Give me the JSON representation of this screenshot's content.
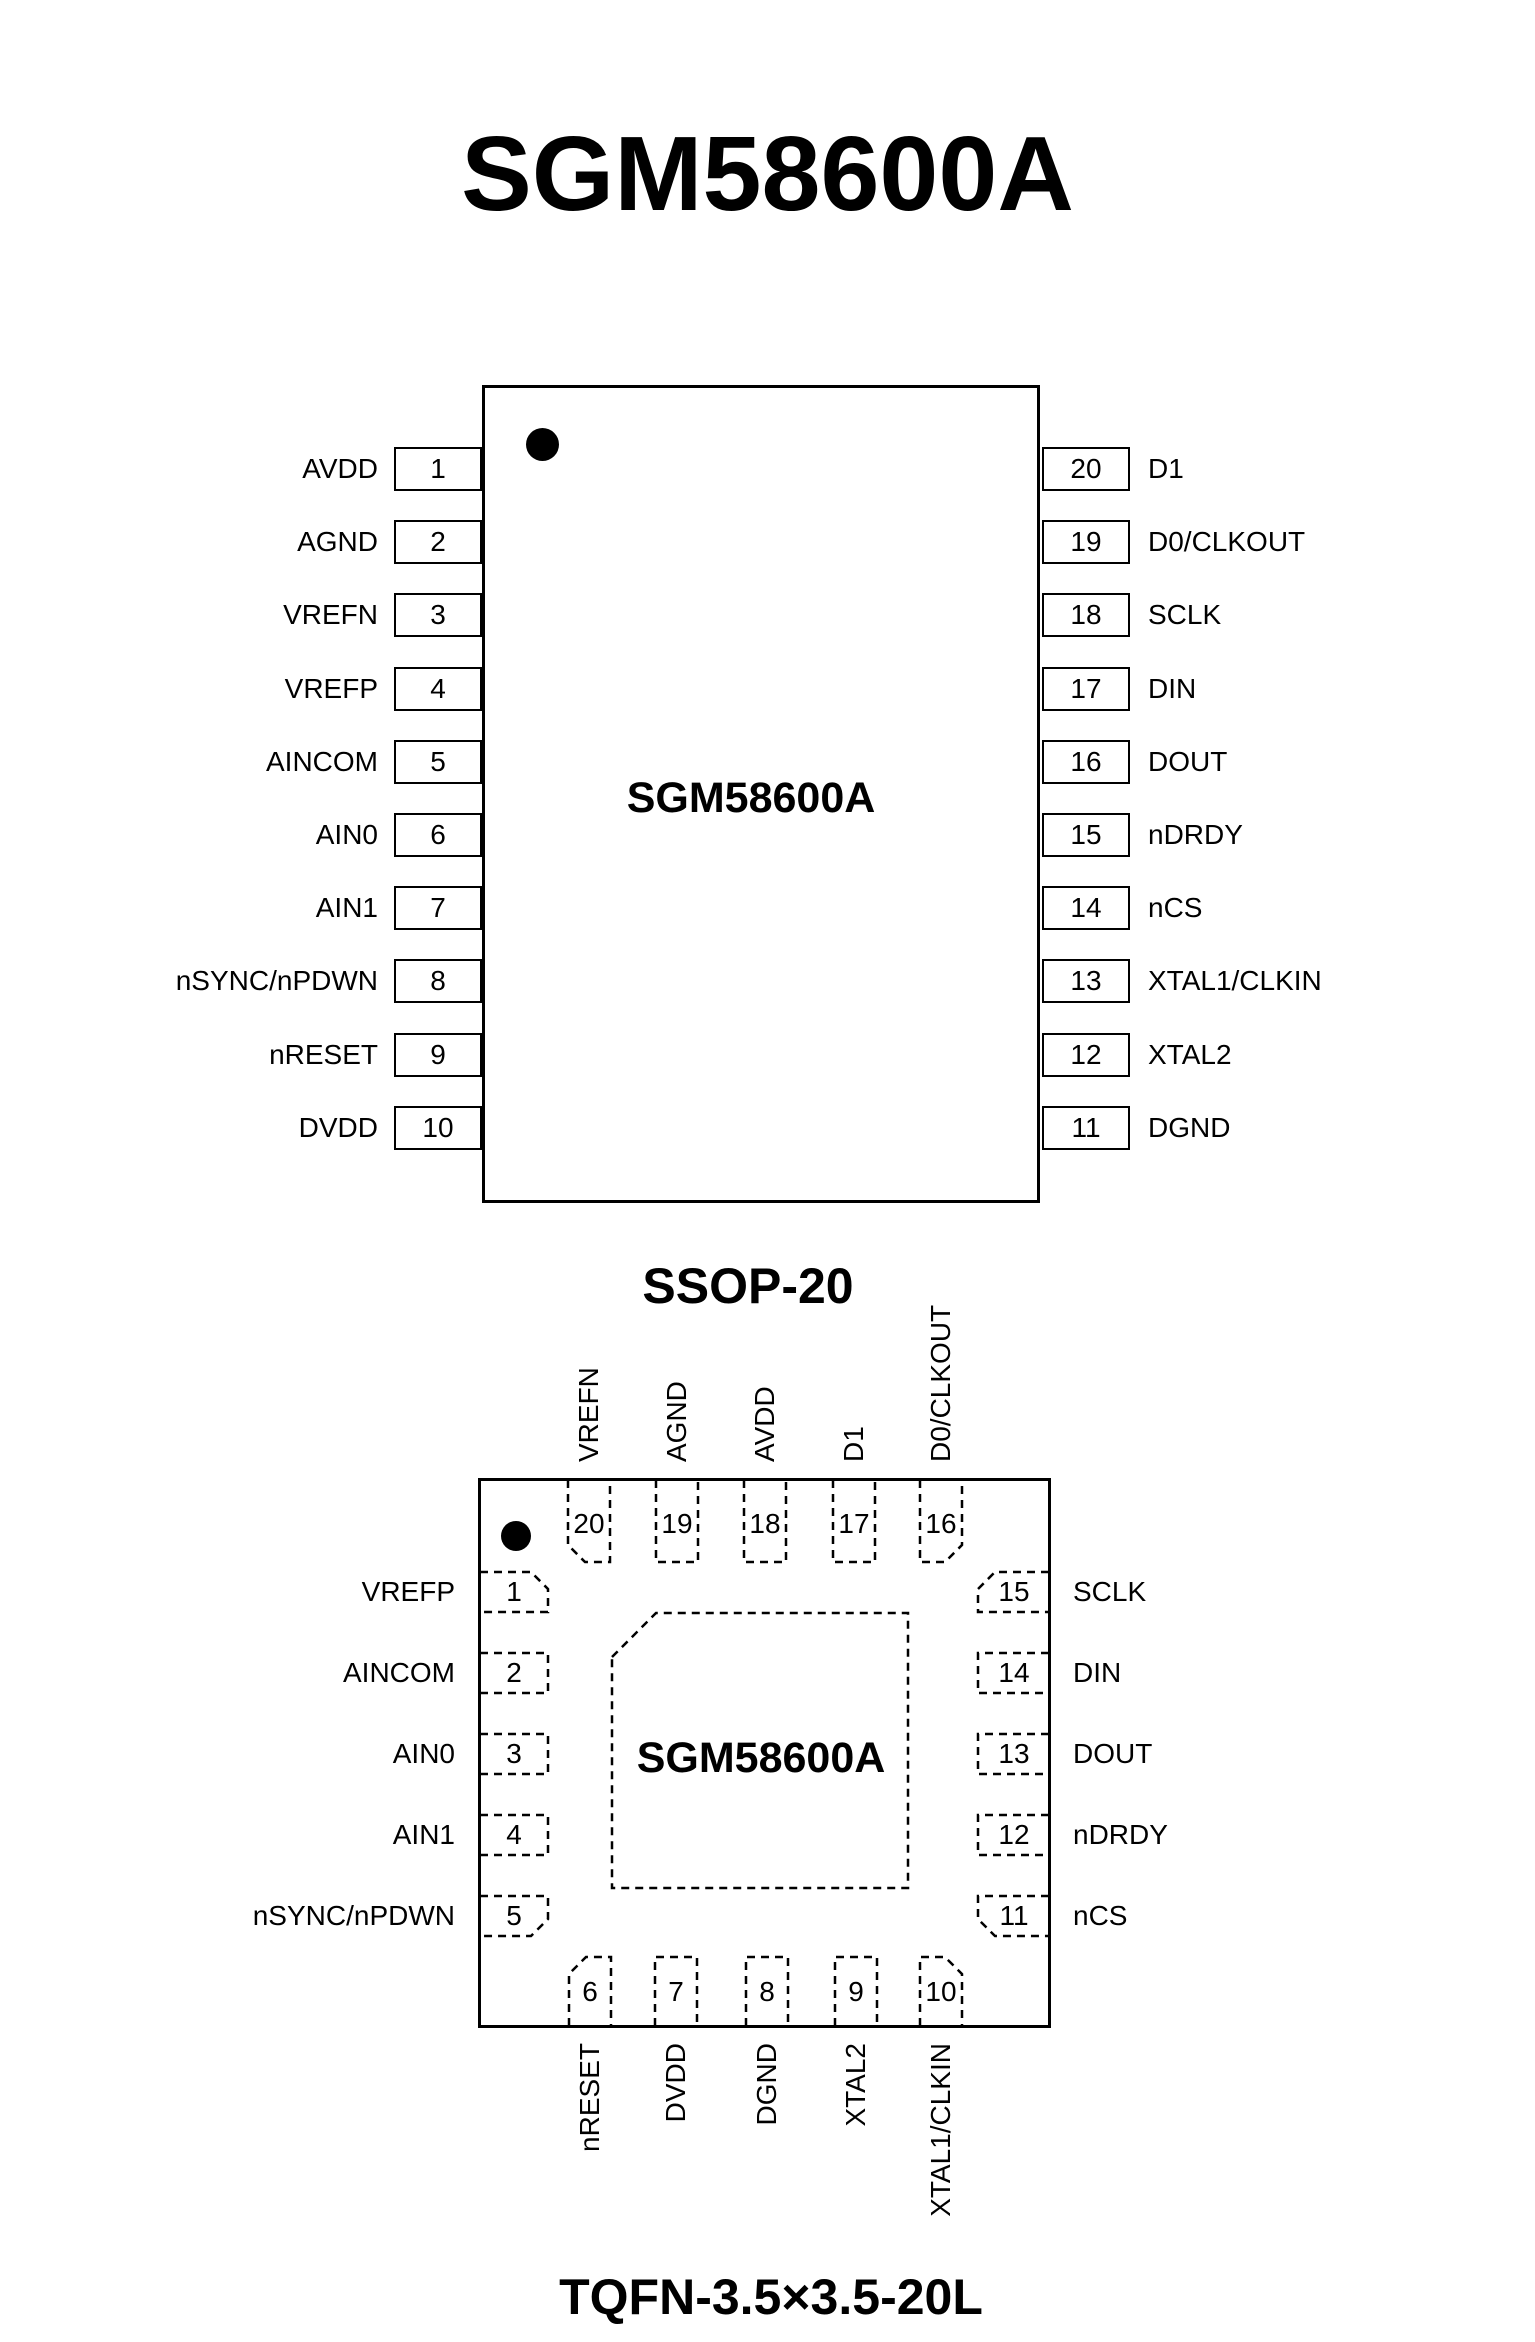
{
  "title": "SGM58600A",
  "ssop": {
    "chip_label": "SGM58600A",
    "caption": "SSOP-20",
    "left_pins": [
      {
        "num": "1",
        "label": "AVDD"
      },
      {
        "num": "2",
        "label": "AGND"
      },
      {
        "num": "3",
        "label": "VREFN"
      },
      {
        "num": "4",
        "label": "VREFP"
      },
      {
        "num": "5",
        "label": "AINCOM"
      },
      {
        "num": "6",
        "label": "AIN0"
      },
      {
        "num": "7",
        "label": "AIN1"
      },
      {
        "num": "8",
        "label": "nSYNC/nPDWN"
      },
      {
        "num": "9",
        "label": "nRESET"
      },
      {
        "num": "10",
        "label": "DVDD"
      }
    ],
    "right_pins": [
      {
        "num": "20",
        "label": "D1"
      },
      {
        "num": "19",
        "label": "D0/CLKOUT"
      },
      {
        "num": "18",
        "label": "SCLK"
      },
      {
        "num": "17",
        "label": "DIN"
      },
      {
        "num": "16",
        "label": "DOUT"
      },
      {
        "num": "15",
        "label": "nDRDY"
      },
      {
        "num": "14",
        "label": "nCS"
      },
      {
        "num": "13",
        "label": "XTAL1/CLKIN"
      },
      {
        "num": "12",
        "label": "XTAL2"
      },
      {
        "num": "11",
        "label": "DGND"
      }
    ]
  },
  "tqfn": {
    "chip_label": "SGM58600A",
    "caption": "TQFN-3.5×3.5-20L",
    "top_pins": [
      {
        "num": "20",
        "label": "VREFN"
      },
      {
        "num": "19",
        "label": "AGND"
      },
      {
        "num": "18",
        "label": "AVDD"
      },
      {
        "num": "17",
        "label": "D1"
      },
      {
        "num": "16",
        "label": "D0/CLKOUT"
      }
    ],
    "left_pins": [
      {
        "num": "1",
        "label": "VREFP"
      },
      {
        "num": "2",
        "label": "AINCOM"
      },
      {
        "num": "3",
        "label": "AIN0"
      },
      {
        "num": "4",
        "label": "AIN1"
      },
      {
        "num": "5",
        "label": "nSYNC/nPDWN"
      }
    ],
    "right_pins": [
      {
        "num": "15",
        "label": "SCLK"
      },
      {
        "num": "14",
        "label": "DIN"
      },
      {
        "num": "13",
        "label": "DOUT"
      },
      {
        "num": "12",
        "label": "nDRDY"
      },
      {
        "num": "11",
        "label": "nCS"
      }
    ],
    "bottom_pins": [
      {
        "num": "6",
        "label": "nRESET"
      },
      {
        "num": "7",
        "label": "DVDD"
      },
      {
        "num": "8",
        "label": "DGND"
      },
      {
        "num": "9",
        "label": "XTAL2"
      },
      {
        "num": "10",
        "label": "XTAL1/CLKIN"
      }
    ]
  }
}
